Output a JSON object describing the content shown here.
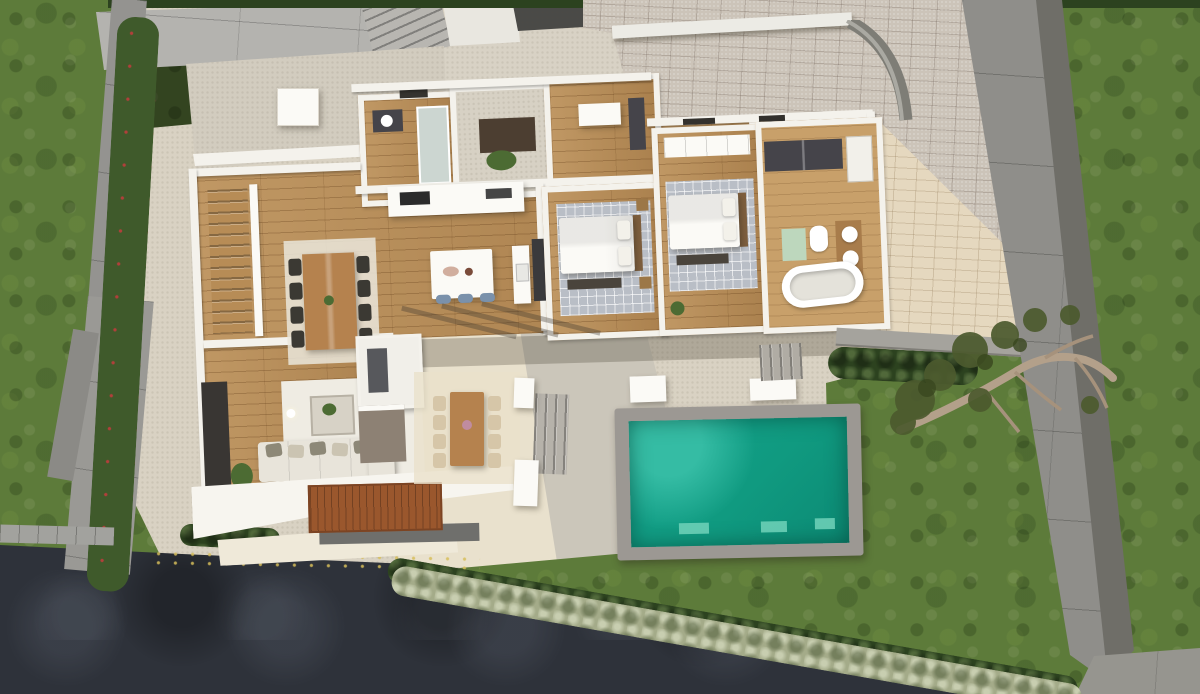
{
  "meta": {
    "title": "Aerial top-down 3D render of a modern single-storey villa (roofless cutaway floor plan)",
    "image_width_px": 1200,
    "image_height_px": 694,
    "view": "top-down dollhouse render, no visible text"
  },
  "palette": {
    "grass": "#5d7b3a",
    "grass_dark": "#47612c",
    "grass_light": "#75914a",
    "hedge_dark": "#2c421f",
    "hedge_mid": "#3f5a2b",
    "hedge_pale": "#a4ab89",
    "asphalt": "#2e323a",
    "patio": "#d9d2c3",
    "patio_light": "#e9e1cd",
    "patio_gray": "#cbc6ba",
    "paver_gray": "#ccc4b9",
    "paver_cream": "#e5d8bf",
    "sidewalk": "#b4b3af",
    "wall_gray": "#949390",
    "wall_gray_dark": "#6f6e68",
    "curb": "#a2a29e",
    "white_wall": "#f4f2ec",
    "white_bright": "#fbfaf6",
    "wood_floor": "#b78c56",
    "wood_deck": "#9a572d",
    "wood_table": "#b5824e",
    "wood_head": "#7e5f3e",
    "rug_gray": "#b9bec6",
    "rug_cream": "#eae6db",
    "sofa": "#e8e4da",
    "pillow_dark": "#8d8877",
    "tv_panel": "#393633",
    "dark_unit": "#45444a",
    "roof_dark": "#4a4a47",
    "pool_coping": "#9c9893",
    "pool_water": "#14a28c",
    "pool_water_deep": "#0c8a74",
    "pool_pad": "#71d2ba",
    "stool_blue": "#7a91ab",
    "bath_mat": "#bdd7bd",
    "plant": "#4c6b33",
    "tree_foliage": "#4c5a2e",
    "tree_trunk": "#b3a08a"
  },
  "scene": {
    "site": {
      "lawns": [
        "left-lawn",
        "right-lawn",
        "back-lawn-wedge"
      ],
      "boundaries": [
        "left-tilted-concrete-wall",
        "right-diagonal-concrete-wall",
        "curved-garden-wall",
        "street-sidewalk-slabs",
        "low-white-street-wall"
      ],
      "hedges": [
        "left-bush-row-with-red-flowers",
        "top-hedge-strip",
        "east-hedge-strip",
        "bottom-diagonal-hedge",
        "driveway-corner-hedge"
      ],
      "hardscape": [
        "herringbone-driveway",
        "cream-herringbone-court",
        "stone-patio",
        "dark-asphalt-driveway",
        "entry-steps",
        "curb-blocks"
      ],
      "tree": "olive-tree-leaning-over-right-wall"
    },
    "house": {
      "style": "flat-roof modern villa, ground floor cutaway",
      "rooms": [
        {
          "id": "stair-hall",
          "furniture": [
            "l-shaped-staircase",
            "white-railing"
          ]
        },
        {
          "id": "dining-area",
          "furniture": [
            "wood-dining-table",
            "8-dark-chairs",
            "cream-rug"
          ]
        },
        {
          "id": "kitchen",
          "furniture": [
            "white-island",
            "3-blue-stools",
            "counter-with-cooktop",
            "tall-fridge-column",
            "sink-counter"
          ]
        },
        {
          "id": "living-room",
          "furniture": [
            "l-shaped-cream-sofa",
            "5-pillows",
            "coffee-table",
            "tv-media-wall",
            "white-rug",
            "floor-plant",
            "floor-lamp"
          ]
        },
        {
          "id": "guest-shower-room",
          "furniture": [
            "dark-vanity-with-round-sink",
            "glass-shower"
          ]
        },
        {
          "id": "entry-foyer",
          "furniture": [
            "dark-doormat",
            "planting"
          ]
        },
        {
          "id": "study-bedroom-3",
          "furniture": [
            "white-dresser",
            "dark-wardrobe"
          ]
        },
        {
          "id": "bedroom-1",
          "furniture": [
            "double-bed",
            "2-pillows",
            "gray-checkered-rug",
            "foot-bench",
            "nightstands"
          ]
        },
        {
          "id": "bedroom-2",
          "furniture": [
            "double-bed",
            "2-pillows",
            "gray-checkered-rug",
            "foot-bench",
            "white-wardrobe"
          ]
        },
        {
          "id": "bathroom",
          "furniture": [
            "freestanding-bathtub",
            "double-round-sinks",
            "toilet",
            "green-bath-mat",
            "dark-wardrobe-units",
            "shower"
          ]
        }
      ],
      "exterior_attached": [
        "outdoor-kitchen-unit",
        "white-cantilever-terrace",
        "terracotta-deck",
        "stone-entry-terrace",
        "white-parapet"
      ]
    },
    "outdoor_living": {
      "pool": {
        "shape": "rectangular",
        "water_color_name": "turquoise",
        "coping": "gray concrete",
        "underwater_pads": 3
      },
      "patio_furniture": [
        "outdoor-dining-table",
        "8-light-chairs",
        "2-white-planters",
        "2-white-benches"
      ],
      "stairs": [
        "wide-patio-steps",
        "pool-east-steps",
        "long-east-step-band"
      ],
      "shadows": [
        "pergola-beam-shadows",
        "long-evening-shadows"
      ]
    }
  }
}
